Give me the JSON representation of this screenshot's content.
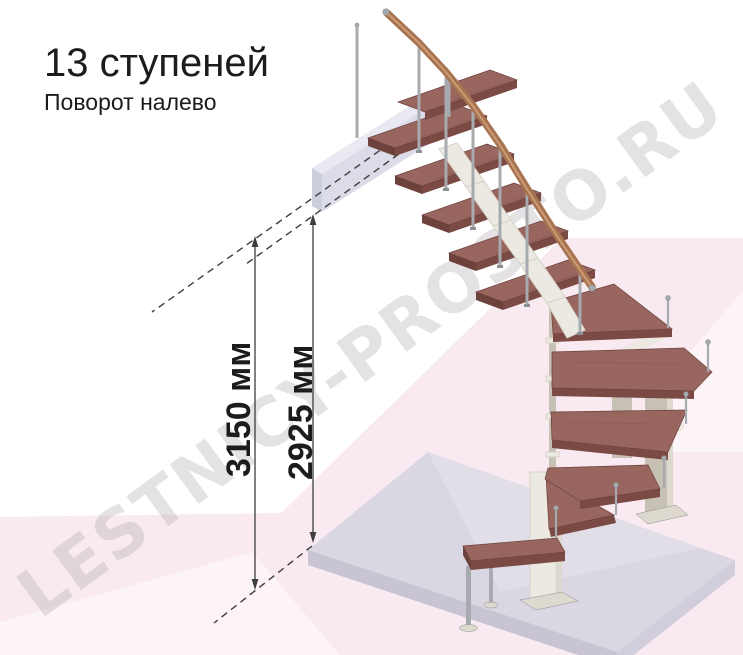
{
  "header": {
    "title": "13 ступеней",
    "subtitle": "Поворот налево"
  },
  "dimensions": [
    {
      "id": "total-height",
      "label": "3150 мм"
    },
    {
      "id": "floor-to-platform-height",
      "label": "2925 мм"
    }
  ],
  "watermark": {
    "text": "LESTNICY-PROSTO.RU"
  },
  "diagram": {
    "type": "staircase-3d-render",
    "steps_count": 13,
    "turn": "left",
    "parts": [
      "upper-platform-beam",
      "straight-flight",
      "winder-turn-treads",
      "bottom-step",
      "floor-slab",
      "handrail",
      "balusters",
      "central-columns"
    ]
  },
  "colors": {
    "text": "#1c1c1c",
    "line": "#3d3d3d",
    "tread_top": "#98665e",
    "tread_front": "#7b4a44",
    "tread_side": "#6d413c",
    "rail": "#a87450",
    "rail_light": "#c99c77",
    "metal": "#a7aaae",
    "metal_dark": "#8c8f93",
    "spine": "#ece9e2",
    "spine_edge": "#d6d2c7",
    "column": "#c7c0b4",
    "column_light": "#ded9cf",
    "floor_top": "#dad6e2",
    "floor_front": "#c8c4d2",
    "floor_side": "#d1cddb",
    "platform_top": "#e6e7f0",
    "platform_front": "#d7d8e5",
    "platform_side": "#c7c8d7",
    "bg_pink": "#f8eaf0",
    "bg_pink_light": "#fdf4f8",
    "watermark": "rgba(172,164,172,0.32)"
  }
}
